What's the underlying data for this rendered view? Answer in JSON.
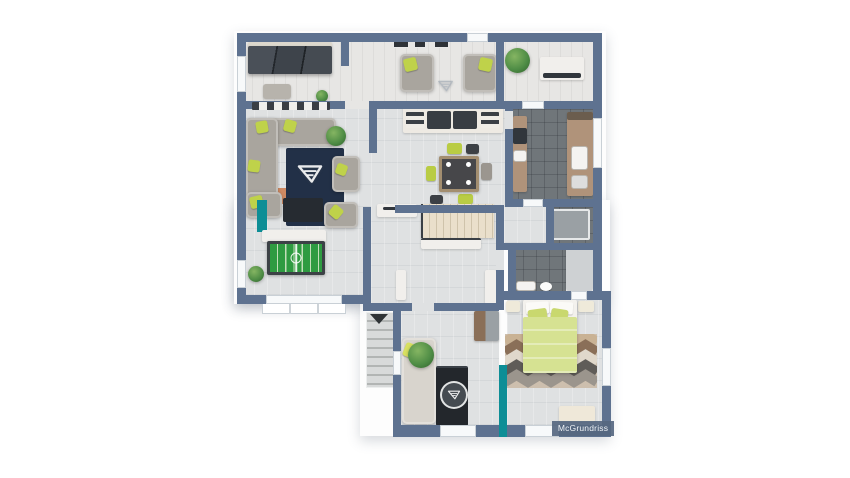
{
  "watermark": {
    "label": "McGrundriss"
  },
  "branding": {
    "logo_icon": "triangle-m-logo",
    "logo_style": "white outlined triangle with inner bars"
  },
  "palette": {
    "wall": "#5e7290",
    "floor_light": "#dfe1e2",
    "floor_warm": "#e7e6e4",
    "tile_dark": "#70767a",
    "accent_lime": "#bfd24a",
    "accent_teal": "#0d8e96",
    "sofa_gray": "#a9a59e",
    "furniture_dark": "#31363c",
    "rug_navy": "#223047",
    "wood": "#b0937a",
    "plant_green": "#4e8c45",
    "stairs_beige": "#eadfcb",
    "bed_lime": "#d6e292",
    "foosball_green": "#2e9b41"
  },
  "scene": {
    "type": "3d-floor-plan-top-view",
    "rooms": [
      "wardrobe-room",
      "sitting-area",
      "pantry",
      "living-room",
      "dining-area",
      "kitchen",
      "hallway-with-stairs",
      "shower-room",
      "bathroom",
      "games-room",
      "study",
      "bedroom"
    ],
    "furniture": [
      "dark-wardrobe",
      "two-armchairs",
      "large-plant",
      "white-sideboard",
      "corner-sofa-with-lime-pillows",
      "navy-rug-with-logo",
      "armchair",
      "tv-lowboard",
      "dining-table-with-plates",
      "lime-and-gray-chairs",
      "kitchen-counters-with-sink",
      "interior-staircase",
      "exterior-staircase",
      "foosball-table",
      "double-bed-lime-duvet",
      "nightstands",
      "chevron-rug",
      "bench",
      "upright-piano-with-logo",
      "small-sofa",
      "shower-cabin",
      "bathroom-wardrobe"
    ]
  }
}
